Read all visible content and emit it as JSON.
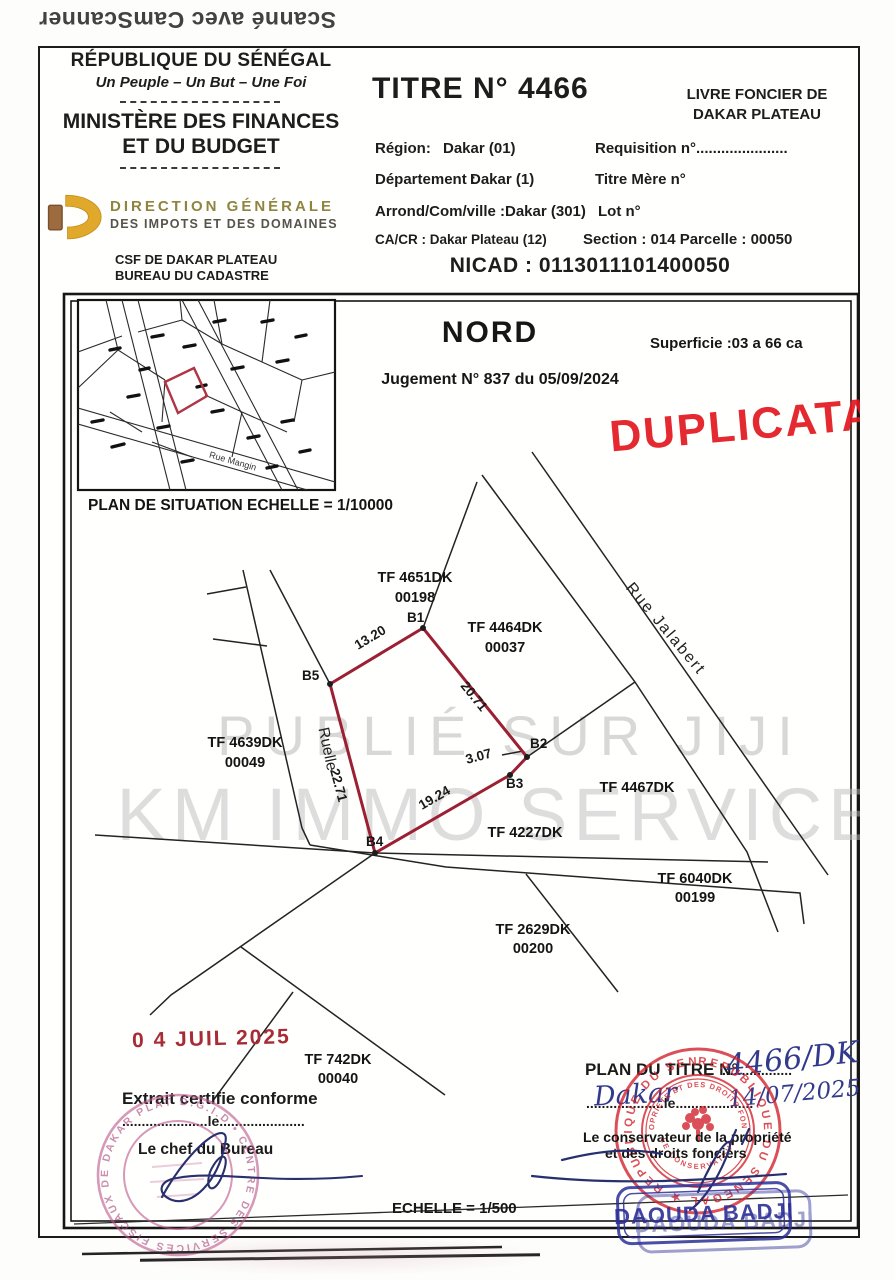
{
  "scan": {
    "camscanner": "Scanné avec CamScanner"
  },
  "header": {
    "republic": "RÉPUBLIQUE DU SÉNÉGAL",
    "motto": "Un Peuple – Un But – Une Foi",
    "ministry1": "MINISTÈRE DES FINANCES",
    "ministry2": "ET DU BUDGET",
    "direction1": "DIRECTION GÉNÉRALE",
    "direction2": "DES IMPOTS ET DES DOMAINES",
    "csf1": "CSF DE DAKAR PLATEAU",
    "csf2": "BUREAU DU CADASTRE",
    "titre": "TITRE N° 4466",
    "livre1": "LIVRE FONCIER DE",
    "livre2": "DAKAR PLATEAU",
    "rows": {
      "region_label": "Région:",
      "region_value": "Dakar (01)",
      "requisition": "Requisition n°......................",
      "departement_label": "Département :",
      "departement_value": "Dakar (1)",
      "titre_mere": "Titre Mère n°",
      "arrond_label": "Arrond/Com/ville :",
      "arrond_value": "Dakar (301)",
      "lot": "Lot n°",
      "cacr": "CA/CR : Dakar Plateau (12)",
      "section_parcelle": "Section : 014   Parcelle : 00050"
    },
    "nicad": "NICAD : 0113011101400050"
  },
  "plan": {
    "situation_caption": "PLAN DE SITUATION ECHELLE = 1/10000",
    "rue_mangin": "Rue Mangin",
    "nord": "NORD",
    "superficie": "Superficie :03 a 66 ca",
    "jugement": "Jugement N° 837 du 05/09/2024",
    "duplicata": "DUPLICATA",
    "watermark_top": "PUBLIÉ SUR JIJI",
    "watermark_bottom": "KM IMMO SERVICE",
    "streets": {
      "ruelle": "Ruelle",
      "rue_jalabert": "Rue    Jalabert"
    },
    "parcels": [
      {
        "tf": "TF 4651DK",
        "num": "00198"
      },
      {
        "tf": "TF 4464DK",
        "num": "00037"
      },
      {
        "tf": "TF 4639DK",
        "num": "00049"
      },
      {
        "tf": "TF 4467DK",
        "num": ""
      },
      {
        "tf": "TF 4227DK",
        "num": ""
      },
      {
        "tf": "TF 6040DK",
        "num": "00199"
      },
      {
        "tf": "TF 2629DK",
        "num": "00200"
      },
      {
        "tf": "TF 742DK",
        "num": "00040"
      }
    ],
    "vertices": {
      "b1": "B1",
      "b2": "B2",
      "b3": "B3",
      "b4": "B4",
      "b5": "B5"
    },
    "edges": {
      "b5b1": "13.20",
      "b1b2": "20.71",
      "b2b3": "3.07",
      "b3b4": "19.24",
      "b4b5": "22.71"
    },
    "echelle": "ECHELLE = 1/500"
  },
  "certification": {
    "date_stamp": "0 4 JUIL 2025",
    "extrait": "Extrait certifie conforme",
    "le_dots": "......................le......................",
    "chef": "Le chef du Bureau",
    "round_stamp_ring": "D.G.I.D • CENTRE DES SERVICES FISCAUX DE DAKAR PLATEAU •"
  },
  "conservation": {
    "plan_du_titre": "PLAN DU TITRE N°",
    "dots1": "..................",
    "titre_hand": "4466/DK",
    "ville_hand": "Dakar",
    "dots2": "....................le....................",
    "date_hand": "14/07/2025",
    "conservateur1": "Le conservateur de la propriété",
    "conservateur2": "et des droits fonciers",
    "seal_ring": "REPUBLIQUE DU SENEGAL  ★  REPUBLIQUE DU SENEGAL  ★",
    "seal_inner_top": "LA PROPRIETE ET DES DROITS FONCIERS",
    "seal_inner_bottom": "LE CONSERVATEUR",
    "name_stamp": "DAOUDA BADJI"
  }
}
